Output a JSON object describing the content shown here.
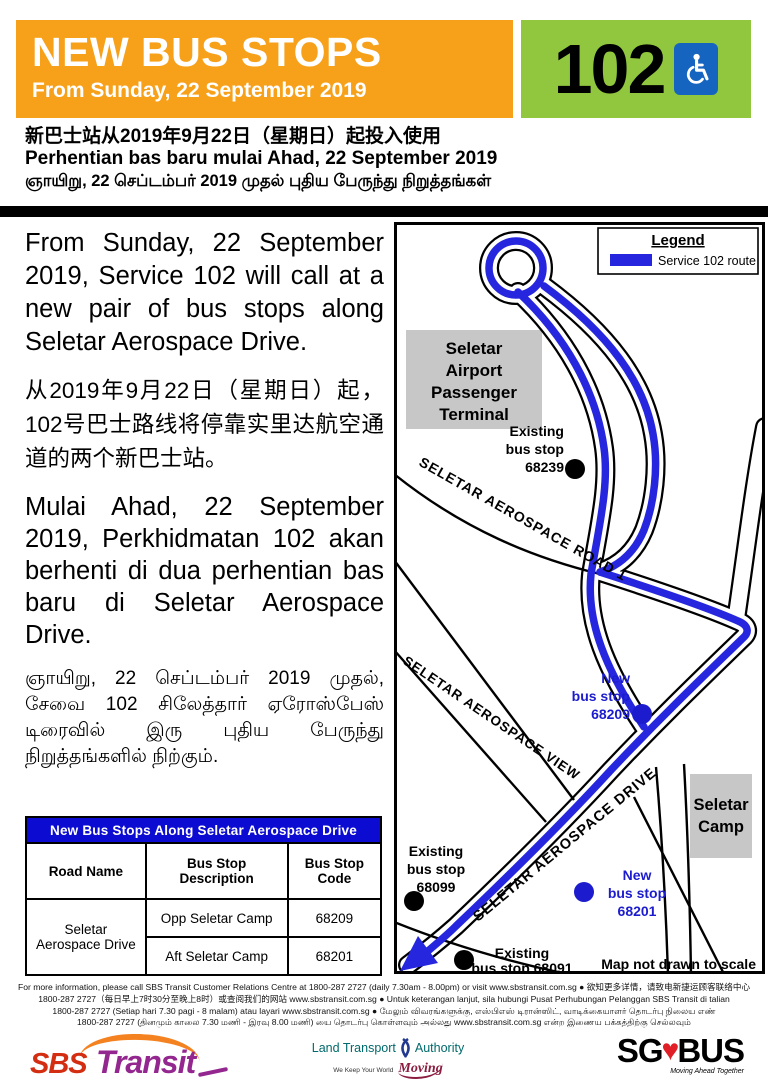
{
  "header": {
    "title": "NEW BUS STOPS",
    "subtitle": "From Sunday, 22 September 2019",
    "route_number": "102"
  },
  "trilingual": {
    "chinese": "新巴士站从2019年9月22日（星期日）起投入使用",
    "malay": "Perhentian bas baru mulai Ahad, 22 September 2019",
    "tamil": "ஞாயிறு, 22 செப்டம்பர் 2019 முதல் புதிய பேருந்து நிறுத்தங்கள்"
  },
  "body": {
    "english": "From Sunday, 22 September 2019, Service 102 will call at a new pair of bus stops along Seletar Aerospace Drive.",
    "chinese": "从2019年9月22日（星期日）起，102号巴士路线将停靠实里达航空通道的两个新巴士站。",
    "malay": "Mulai Ahad, 22 September 2019, Perkhidmatan 102 akan berhenti di dua perhentian bas baru di Seletar Aerospace Drive.",
    "tamil": "ஞாயிறு, 22 செப்டம்பர் 2019 முதல், சேவை 102 சிலேத்தார் ஏரோஸ்பேஸ் டிரைவில் இரு புதிய பேருந்து நிறுத்தங்களில் நிற்கும்."
  },
  "table": {
    "title": "New Bus Stops Along  Seletar Aerospace Drive",
    "headers": [
      "Road Name",
      "Bus Stop Description",
      "Bus Stop Code"
    ],
    "road_name": "Seletar Aerospace Drive",
    "rows": [
      {
        "description": "Opp Seletar Camp",
        "code": "68209"
      },
      {
        "description": "Aft Seletar Camp",
        "code": "68201"
      }
    ]
  },
  "map": {
    "legend": {
      "title": "Legend",
      "route_label": "Service 102 route"
    },
    "route_color": "#2626DF",
    "areas": [
      {
        "lines": [
          "Seletar",
          "Airport",
          "Passenger",
          "Terminal"
        ]
      },
      {
        "lines": [
          "Seletar",
          "Camp"
        ]
      }
    ],
    "road_labels": [
      "SELETAR AEROSPACE ROAD 1",
      "SELETAR AEROSPACE VIEW",
      "SELETAR AEROSPACE DRIVE"
    ],
    "stops": [
      {
        "type": "existing",
        "lines": [
          "Existing",
          "bus stop",
          "68239"
        ]
      },
      {
        "type": "new",
        "lines": [
          "New",
          "bus stop",
          "68209"
        ]
      },
      {
        "type": "existing",
        "lines": [
          "Existing",
          "bus stop",
          "68099"
        ]
      },
      {
        "type": "new",
        "lines": [
          "New",
          "bus stop",
          "68201"
        ]
      },
      {
        "type": "existing",
        "lines": [
          "Existing",
          "bus stop 68091"
        ]
      }
    ],
    "note": "Map not drawn to scale"
  },
  "footer": {
    "lines": [
      "For more information, please call SBS Transit Customer Relations Centre at 1800-287 2727 (daily 7.30am - 8.00pm) or visit www.sbstransit.com.sg  ●  欲知更多详情，请致电新捷运顾客联络中心",
      "1800-287 2727（每日早上7时30分至晚上8时）或查阅我们的网站 www.sbstransit.com.sg  ●  Untuk keterangan lanjut, sila hubungi Pusat Perhubungan Pelanggan SBS Transit di talian",
      "1800-287 2727 (Setiap hari 7.30 pagi - 8 malam) atau layari www.sbstransit.com.sg  ●  மேலும் விவரங்களுக்கு, எஸ்பிஎஸ் டிரான்ஸிட், வாடிக்கையாளர் தொடர்பு நிலைய எண்",
      "1800-287 2727 (தினமும் காலை 7.30 மணி - இரவு 8.00 மணி) யை தொடர்பு கொள்ளவும் அல்லது www.sbstransit.com.sg என்ற இணைய பக்கத்திற்கு செல்லவும்"
    ],
    "logos": {
      "sbs": {
        "part1": "SBS",
        "part2": "Transit"
      },
      "lta": {
        "line1a": "Land Transport",
        "line1b": "Authority",
        "tagline": "We Keep Your World",
        "script": "Moving"
      },
      "sgbus": {
        "part1": "SG",
        "heart": "♥",
        "part2": "BUS",
        "tagline": "Moving Ahead Together"
      }
    }
  },
  "colors": {
    "banner_orange": "#F7A11A",
    "banner_green": "#90C73E",
    "wheelchair_blue": "#1565C0",
    "table_header_blue": "#0B0BD2",
    "route_blue": "#2626DF",
    "new_stop_text_blue": "#1C1CCE"
  }
}
